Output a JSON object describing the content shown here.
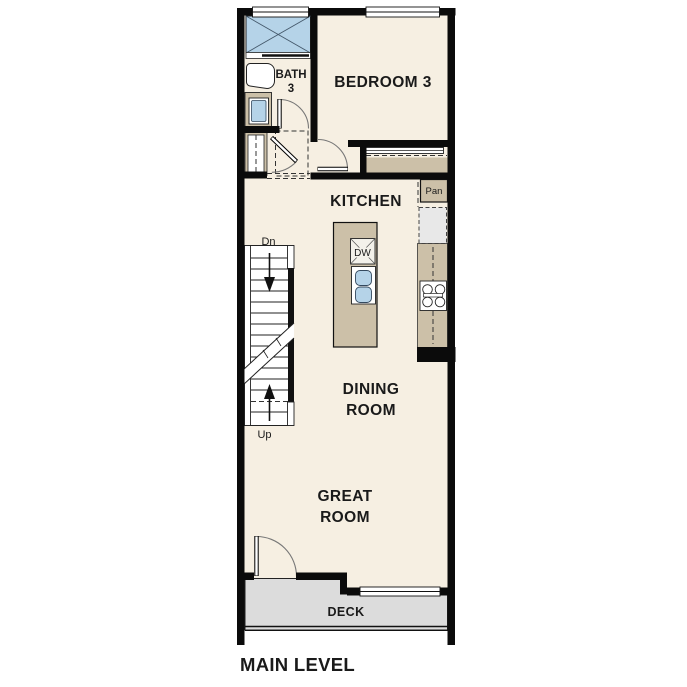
{
  "plan_title": "MAIN LEVEL",
  "rooms": {
    "bedroom3": {
      "name": "BEDROOM 3"
    },
    "bath3": {
      "line1": "BATH",
      "line2": "3"
    },
    "kitchen": {
      "name": "KITCHEN"
    },
    "dining": {
      "line1": "DINING",
      "line2": "ROOM"
    },
    "great": {
      "line1": "GREAT",
      "line2": "ROOM"
    },
    "deck": {
      "name": "DECK"
    }
  },
  "fixtures": {
    "pantry": "Pan",
    "dishwasher": "DW"
  },
  "stairs": {
    "down": "Dn",
    "up": "Up"
  },
  "colors": {
    "wall": "#0b0b0b",
    "floor": "#f6efe2",
    "cabinet_tan": "#ccc0a8",
    "fixture_blue": "#b5d3e8",
    "deck_gray": "#dcdcdc",
    "appliance_gray": "#e8e8e8"
  }
}
